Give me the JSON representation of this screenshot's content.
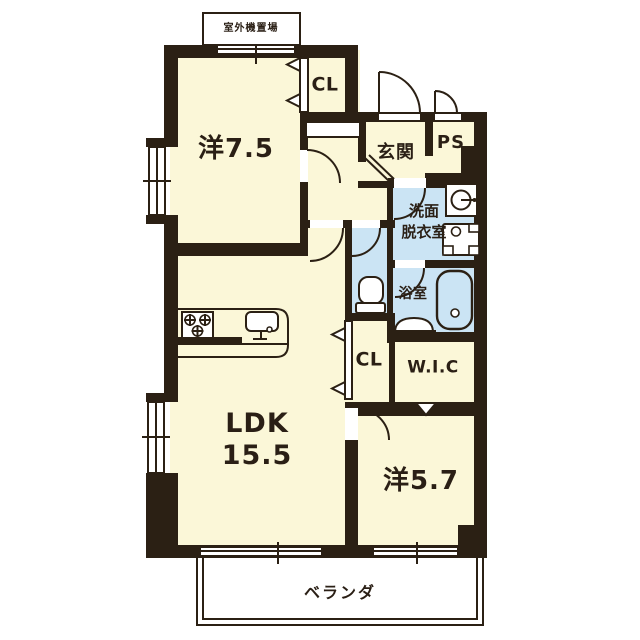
{
  "meta": {
    "type": "apartment-floor-plan"
  },
  "colors": {
    "wall": "#2b2014",
    "room_floor": "#fbf7d8",
    "wet_area_floor": "#cbe4f4",
    "text": "#2a1f15",
    "background": "#ffffff"
  },
  "labels": {
    "outdoor_unit": "室外機置場",
    "western_room_large": "洋7.5",
    "closet_top": "CL",
    "entrance": "玄関",
    "pipe_space": "PS",
    "washroom_line1": "洗面",
    "washroom_line2": "脱衣室",
    "bathroom": "浴室",
    "ldk_name": "LDK",
    "ldk_size": "15.5",
    "closet_mid": "CL",
    "walk_in_closet": "W.I.C",
    "western_room_small": "洋5.7",
    "veranda": "ベランダ"
  }
}
